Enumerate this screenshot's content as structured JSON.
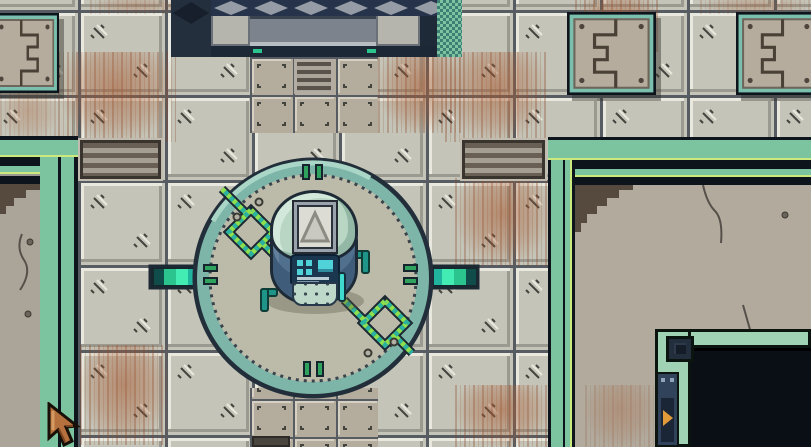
{
  "scene": {
    "name": "facility-room-topdown",
    "view": "top-down pixel-art game scene",
    "entities": [
      {
        "name": "teleporter-platform",
        "shape": "circle",
        "center_x": 313,
        "center_y": 278,
        "radius": 118
      },
      {
        "name": "robot",
        "parts": [
          "dome",
          "screen-triangle",
          "control-panel",
          "speaker-dots",
          "left-arm",
          "right-arm",
          "cyan-rod"
        ]
      },
      {
        "name": "ceiling-machine",
        "position": "top-center"
      },
      {
        "name": "floor-hatch-panel",
        "count": 3,
        "positions": [
          "top-left",
          "top-right",
          "top-far-right"
        ]
      },
      {
        "name": "wall-hatch-panel",
        "position": "right-room"
      },
      {
        "name": "floor-vent",
        "count": 3
      },
      {
        "name": "left-room",
        "trim": "teal"
      },
      {
        "name": "right-room",
        "trim": "teal",
        "features": [
          "dark-doorway",
          "corner-block",
          "arrow-sign",
          "cracks"
        ]
      },
      {
        "name": "energy-connector",
        "count": 2,
        "positions": [
          "platform-west",
          "platform-east"
        ]
      },
      {
        "name": "chevron-trail",
        "count": 2,
        "positions": [
          "platform-northwest",
          "platform-southeast"
        ]
      },
      {
        "name": "mouse-cursor",
        "x": 48,
        "y": 405,
        "style": "tan pixel arrow pointing up-left"
      }
    ]
  },
  "palette": {
    "floor-base": "#c4c4b8",
    "floor-seam": "#565c62",
    "floor-highlight": "#e8e8de",
    "floor-shade": "#9a9a90",
    "mark-dark": "#44443f",
    "smalltile-base": "#b4ad9e",
    "smalltile-hi": "#d6d0c2",
    "rust": "#a85c34",
    "trim-teal": "#7cc49f",
    "trim-accent": "#cbe97d",
    "trim-dark": "#0d141c",
    "room-floor": "#aba599",
    "platform-face": "#bcbbaa",
    "platform-rim": "#7db5a9",
    "tick-green": "#2fa35e",
    "chevron-green": "#8ee04e",
    "chevron-teal": "#2bb2a0",
    "teal-bright": "#2cc48e",
    "machine-navy": "#26334a",
    "machine-navy-deep": "#1f2a38",
    "machine-gray": "#7d838d",
    "machine-gray-light": "#959ca6",
    "dither-dark": "#3f7e74",
    "robot-dome": "#b9d6c5",
    "robot-body": "#50708e",
    "robot-panel": "#1b3750",
    "robot-cyan": "#4fd2d8",
    "robot-mint": "#bed9c9",
    "robot-rod": "#3fd9cf",
    "arm-teal": "#1f9488",
    "hatch-teal": "#7bbfae",
    "hatch-tan": "#b6ac9d",
    "hatch-line": "#494136",
    "door-mint": "#9fd3b4",
    "door-dark": "#0a0e15",
    "sign-orange": "#e09a3a",
    "cursor-tan": "#b4713d",
    "cursor-outline": "#181008"
  }
}
